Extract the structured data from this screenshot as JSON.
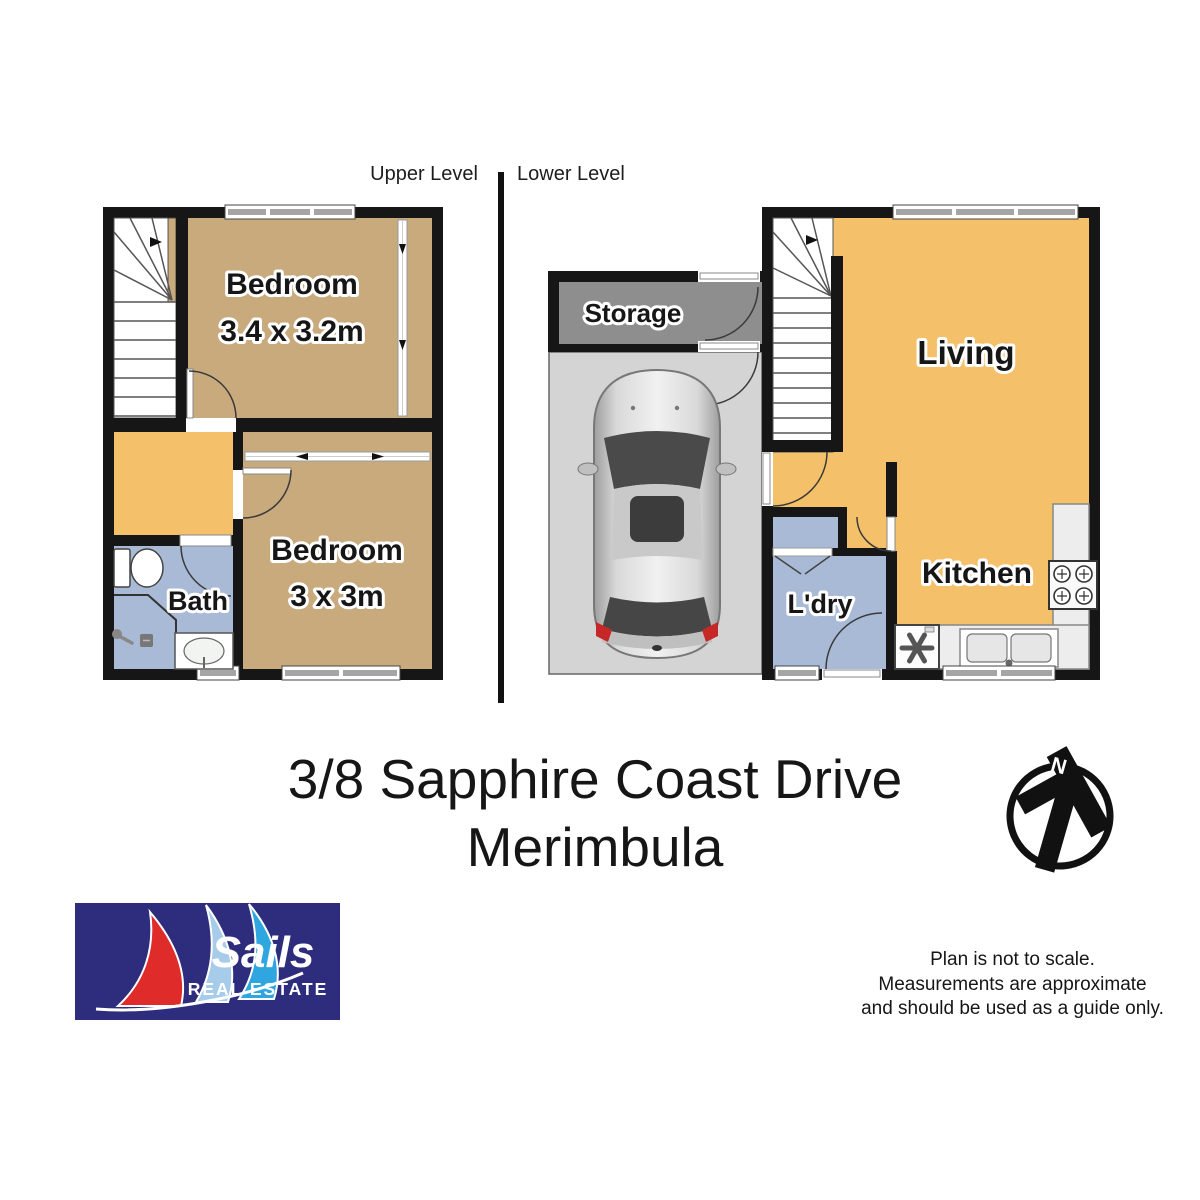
{
  "header": {
    "upper_level_label": "Upper Level",
    "lower_level_label": "Lower Level"
  },
  "title": {
    "line1": "3/8 Sapphire Coast Drive",
    "line2": "Merimbula"
  },
  "disclaimer": {
    "line1": "Plan is not to scale.",
    "line2": "Measurements are approximate",
    "line3": "and should be used as a guide only."
  },
  "upper_level": {
    "bedroom1": {
      "name": "Bedroom",
      "dims": "3.4 x 3.2m"
    },
    "bedroom2": {
      "name": "Bedroom",
      "dims": "3 x 3m"
    },
    "bath": {
      "name": "Bath"
    }
  },
  "lower_level": {
    "storage": {
      "name": "Storage"
    },
    "living": {
      "name": "Living"
    },
    "kitchen": {
      "name": "Kitchen"
    },
    "laundry": {
      "name": "L'dry"
    }
  },
  "north_arrow": {
    "label": "N"
  },
  "logo": {
    "brand": "Sails",
    "tagline": "REAL ESTATE"
  },
  "colors": {
    "wall": "#161616",
    "floor_tan": "#C8AA7D",
    "floor_orange": "#F5C06A",
    "floor_blue": "#A8BAD6",
    "storage_gray": "#8E8E8E",
    "garage_gray": "#D4D4D4",
    "logo_navy": "#2E2C7D",
    "sail_red": "#DF2B2A",
    "sail_pale_blue": "#A6CCEA",
    "sail_sky_blue": "#2FA6DF"
  }
}
